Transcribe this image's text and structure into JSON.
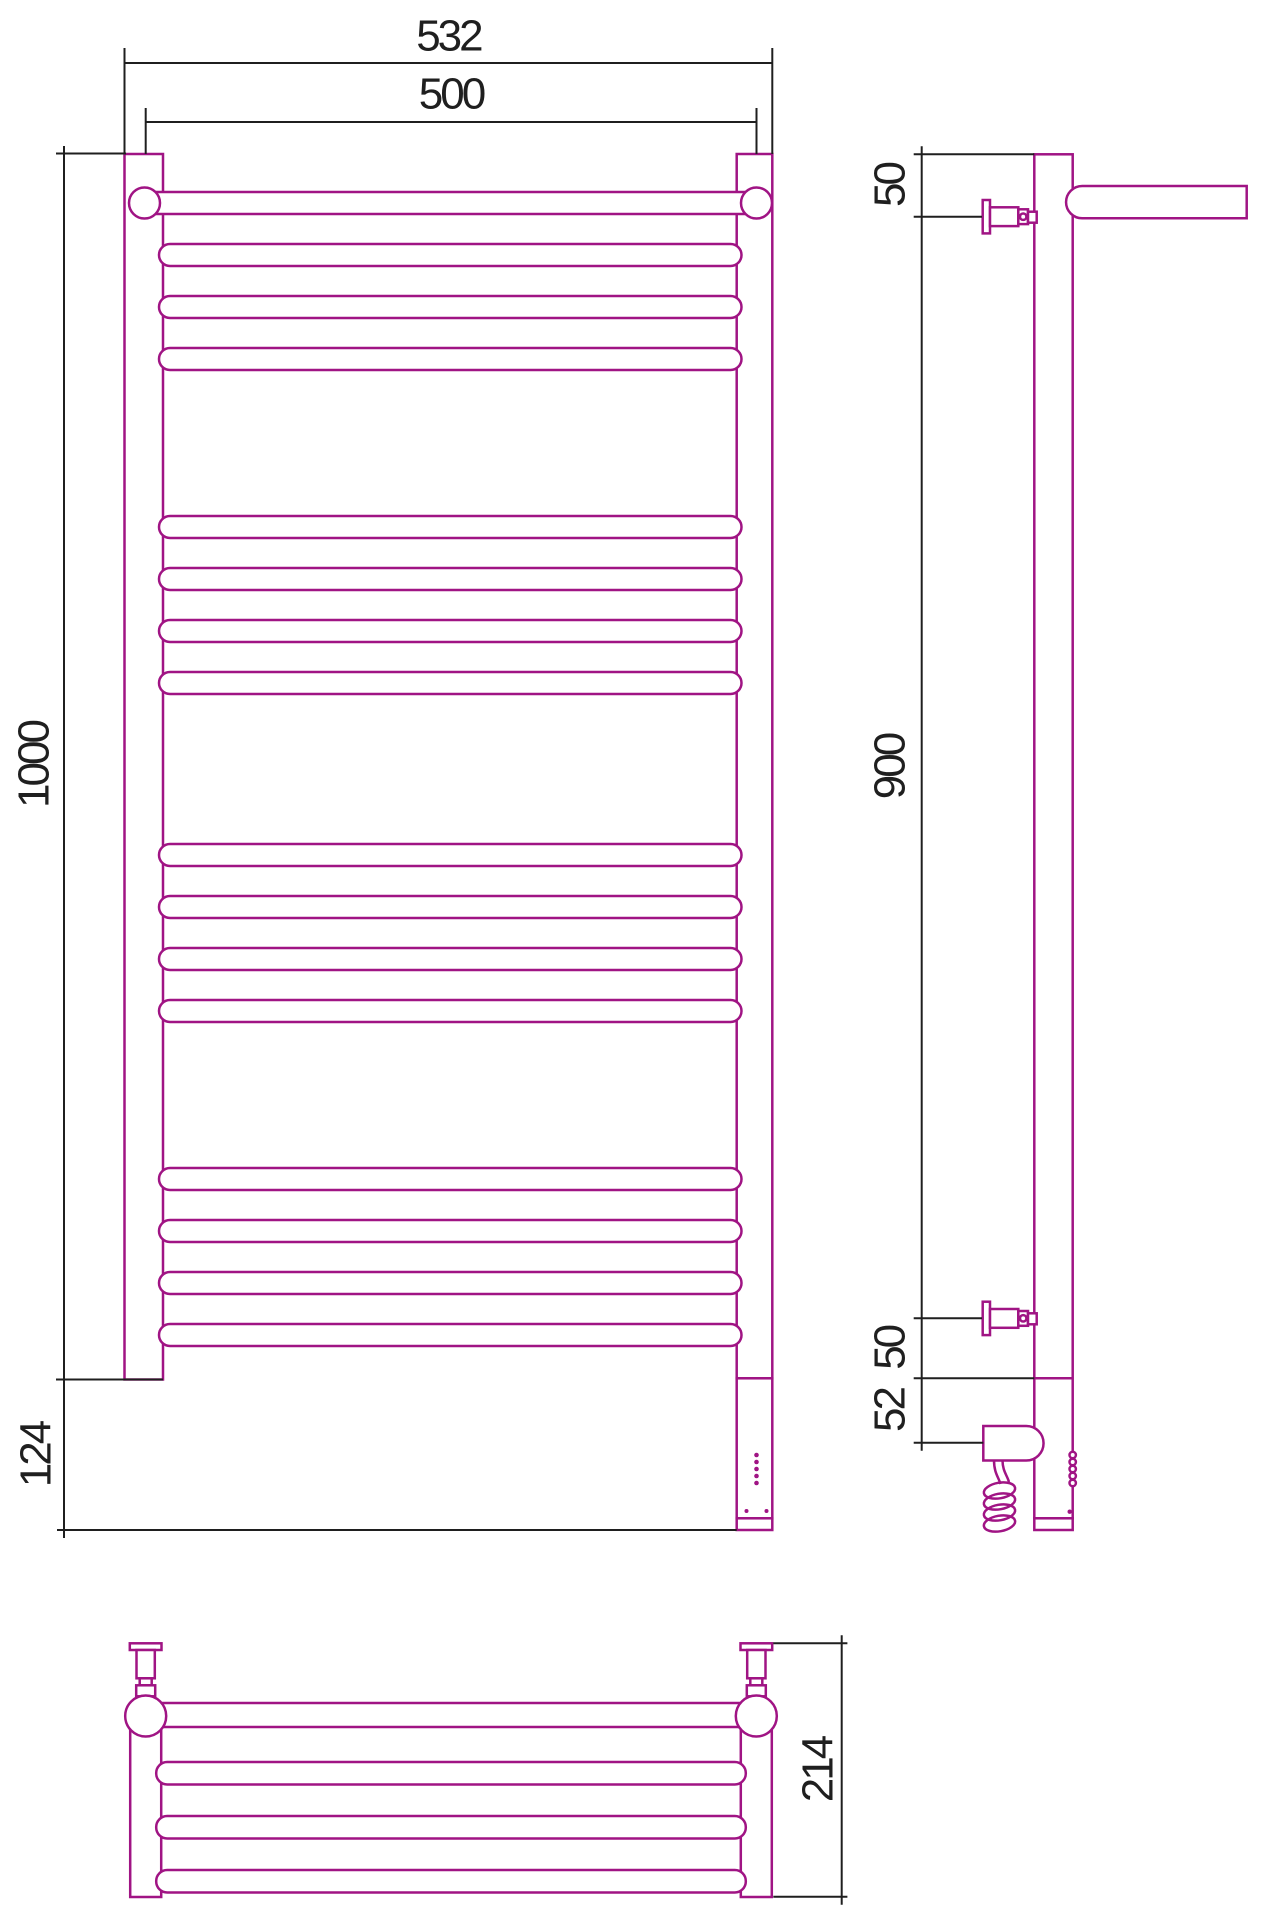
{
  "drawing": {
    "type": "technical-dimension-drawing",
    "subject": "ladder towel rail with shelf, electric right-side connection",
    "views": [
      "front",
      "side",
      "bottom"
    ],
    "dimensions": {
      "overall_width": "532",
      "rail_center_width": "500",
      "rail_height": "1000",
      "bottom_section_height": "124",
      "top_bracket_offset": "50",
      "bracket_span": "900",
      "bottom_bracket_offset": "50",
      "heater_offset": "52",
      "shelf_depth": "214"
    },
    "colors": {
      "product_line": "#A01484",
      "dimension_line": "#1F1F1F",
      "background": "#FFFFFF"
    }
  }
}
